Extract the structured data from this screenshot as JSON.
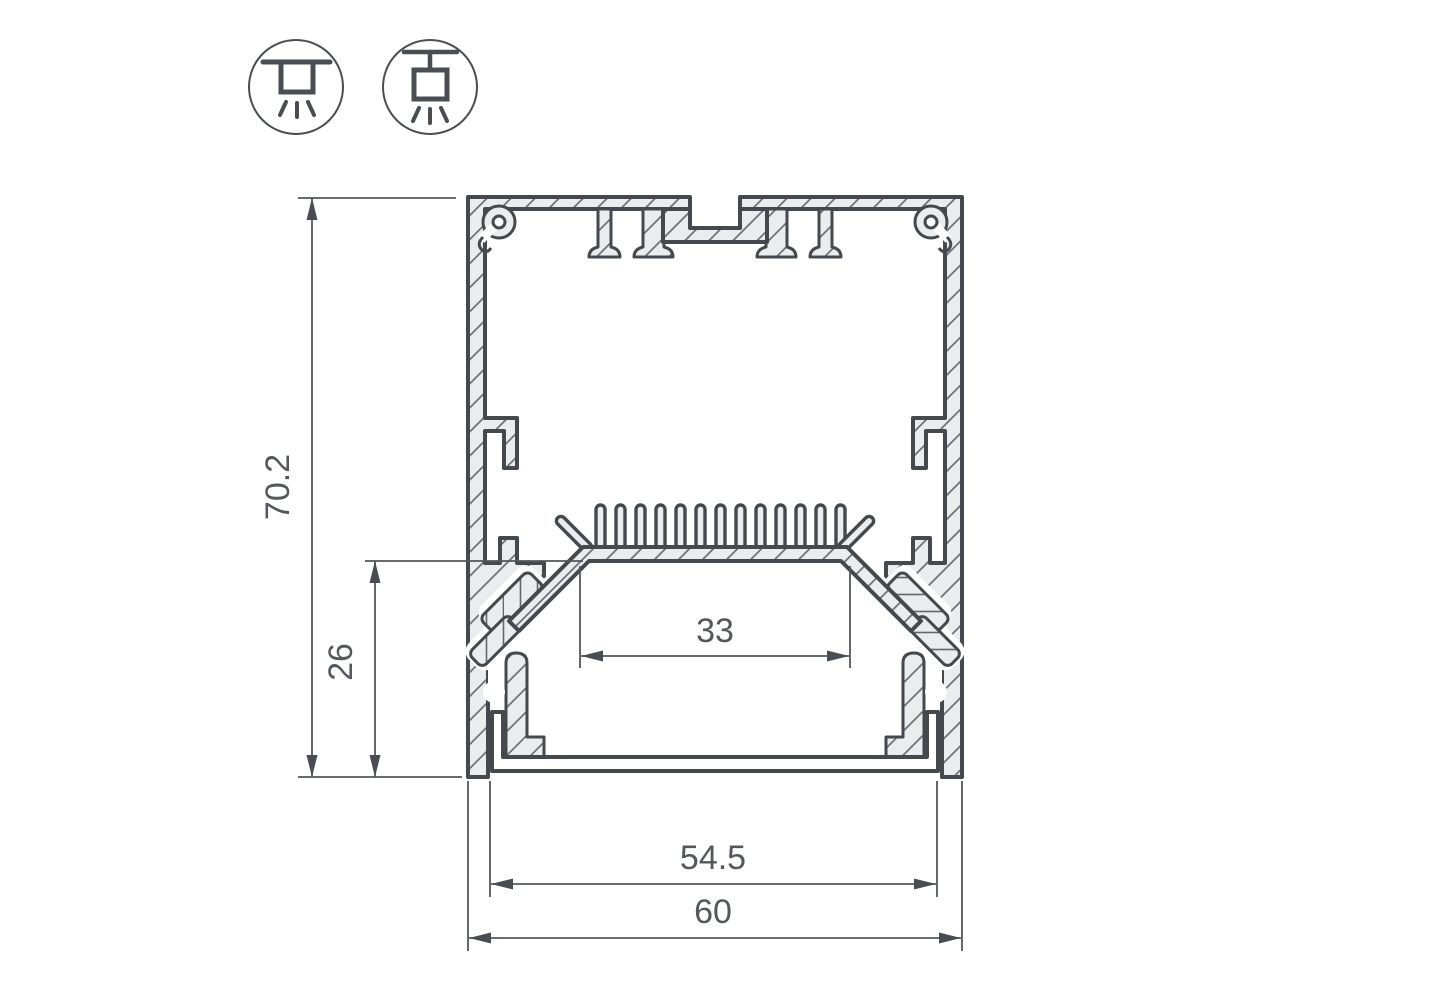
{
  "diagram": {
    "title": "led-profile-cross-section",
    "dimensions": {
      "total_height": "70.2",
      "inner_height": "26",
      "led_platform_width": "33",
      "inner_width": "54.5",
      "total_width": "60"
    },
    "mount_icons": [
      {
        "name": "surface-mount"
      },
      {
        "name": "pendant-mount"
      }
    ],
    "colors": {
      "outline": "#45494d",
      "profile_fill": "#ebeced",
      "hatch_line": "#61666c",
      "dimension_line": "#53575b",
      "label_text": "#54585c",
      "background": "#ffffff"
    }
  }
}
